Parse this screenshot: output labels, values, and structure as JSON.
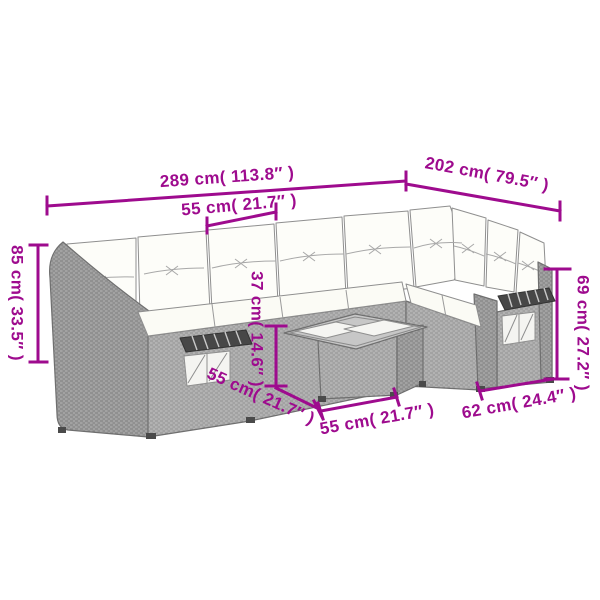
{
  "diagram_title": "",
  "colors": {
    "dimension_accent": "#9E0B8E",
    "wicker_gray": "#b2b2b2",
    "wicker_dark_gray": "#a0a0a0",
    "cushion_white": "#fdfdf9",
    "slat_dark": "#474747",
    "outline_gray": "#6f6f6f",
    "background": "#ffffff"
  },
  "dimensions": [
    {
      "id": "total-width",
      "label": "289 cm( 113.8″ )"
    },
    {
      "id": "total-depth",
      "label": "202 cm( 79.5″ )"
    },
    {
      "id": "seat-width",
      "label": "55 cm( 21.7″ )"
    },
    {
      "id": "back-height",
      "label": "85 cm( 33.5″ )"
    },
    {
      "id": "seat-height",
      "label": "37 cm( 14.6″ )"
    },
    {
      "id": "seat-depth",
      "label": "55 cm( 21.7″ )"
    },
    {
      "id": "table-width",
      "label": "55 cm( 21.7″ )"
    },
    {
      "id": "arm-section-width",
      "label": "62 cm( 24.4″ )"
    },
    {
      "id": "arm-height",
      "label": "69 cm( 27.2″ )"
    }
  ]
}
